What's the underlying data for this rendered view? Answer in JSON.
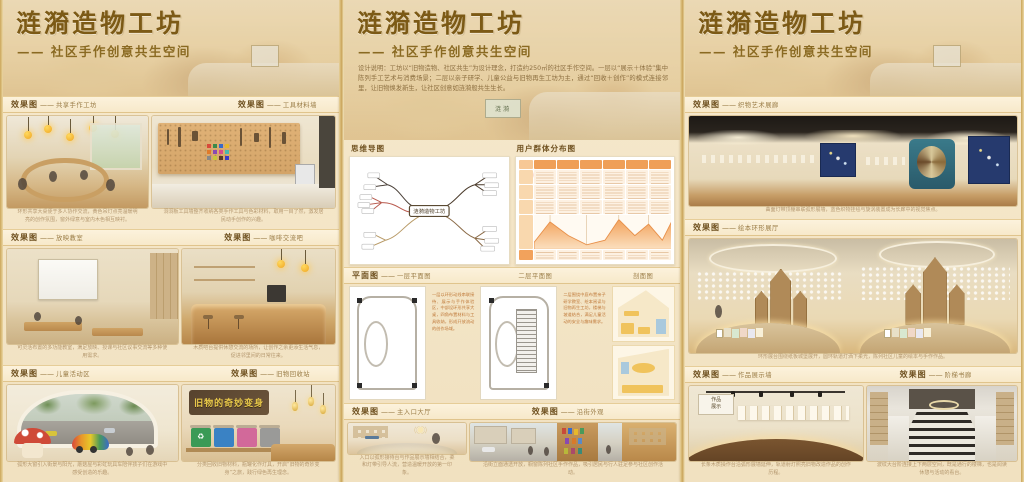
{
  "branding": {
    "title": "涟漪造物工坊",
    "subtitle": "—— 社区手作创意共生空间"
  },
  "labels": {
    "render": "效果图",
    "dash": "——",
    "mindmap": "思维导图",
    "usermap": "用户群体分布图",
    "plans": "平面图",
    "plan1": "一层平面图",
    "plan2": "二层平面图",
    "section": "剖面图"
  },
  "left": {
    "sign_text": "旧物的奇妙变身",
    "cards": [
      {
        "name": "共享手作工坊",
        "caption": "环形共享大桌便于多人协作交流，黄色吊灯点亮温暖明亮的创作氛围，窗外绿意与室内木色相互映衬。"
      },
      {
        "name": "工具材料墙",
        "caption": "洞洞板工具墙整齐收纳各类手作工具与色彩材料，取用一目了然，激发居民动手创作的兴趣。"
      },
      {
        "name": "放映教室",
        "caption": "可灵活布置的多功能教室，满足放映、授课与社区议事交流等多种使用需求。"
      },
      {
        "name": "咖啡交流吧",
        "caption": "木质吧台提供休憩交流的场所，让创作之余更添生活气息，促进邻里间的日常往来。"
      },
      {
        "name": "儿童活动区",
        "caption": "弧形大窗引入街景与阳光，蘑菇屋与彩虹玩具车陪伴孩子们在游戏中感受创造的乐趣。"
      },
      {
        "name": "旧物回收站",
        "caption": "分类回收旧物材料，瓶罐化作灯具，开启“旧物的奇妙变身”之旅，践行绿色再生理念。"
      }
    ]
  },
  "middle": {
    "sign": "涟漪",
    "description": "设计说明：工坊以“旧物造物、社区共生”为设计理念，打造约250㎡的社区手作空间。一层以“展示＋体验”集中陈列手工艺术与消费场景；二层以亲子研学、儿童公益与旧物再生工坊为主，通过“回收＋创作”的模式连接邻里，让旧物焕发新生，让社区创意如涟漪般共生生长。",
    "mindmap_center": "涟漪造物工坊",
    "plan_note1": "一层以环形动线串联接待、展示与手作体验区，中部设环形共享大桌，四角布置材料与工具收纳，形成开放流动的创作场域。",
    "plan_note2": "二层围绕中庭布置亲子研学教室、绘本阅读与旧物再生工坊，楼梯与坡道结合，满足儿童活动的安全与趣味需求。",
    "cards": [
      {
        "name": "主入口大厅",
        "caption": "入口以弧形接待台与作品展示墙相结合，柔和灯带引导人流，营造温暖开放的第一印象。"
      },
      {
        "name": "沿街外观",
        "caption": "沿街立面通透开放，橱窗陈列社区手作作品，吸引居民与行人驻足参与社区创作活动。"
      }
    ]
  },
  "right": {
    "cards": [
      {
        "name": "织物艺术展廊",
        "caption": "曲面灯带顶棚串联弧形展墙，蓝色织物挂毯与旋涡装置成为长廊中的视觉焦点。"
      },
      {
        "name": "绘本环形展厅",
        "caption": "环形展台围绕纸板城堡展开，圆环轨道灯洒下柔光，陈列社区儿童的绘本与手作作品。"
      },
      {
        "name": "作品展示墙",
        "caption": "长条木质操作台沿弧形展墙延伸，轨道射灯照亮旧物改造作品的创作历程。"
      },
      {
        "name": "阶梯书廊",
        "caption": "波纹大台阶连接上下两层空间，既是通行的楼梯，也是阅读休憩与活动的看台。"
      }
    ]
  }
}
